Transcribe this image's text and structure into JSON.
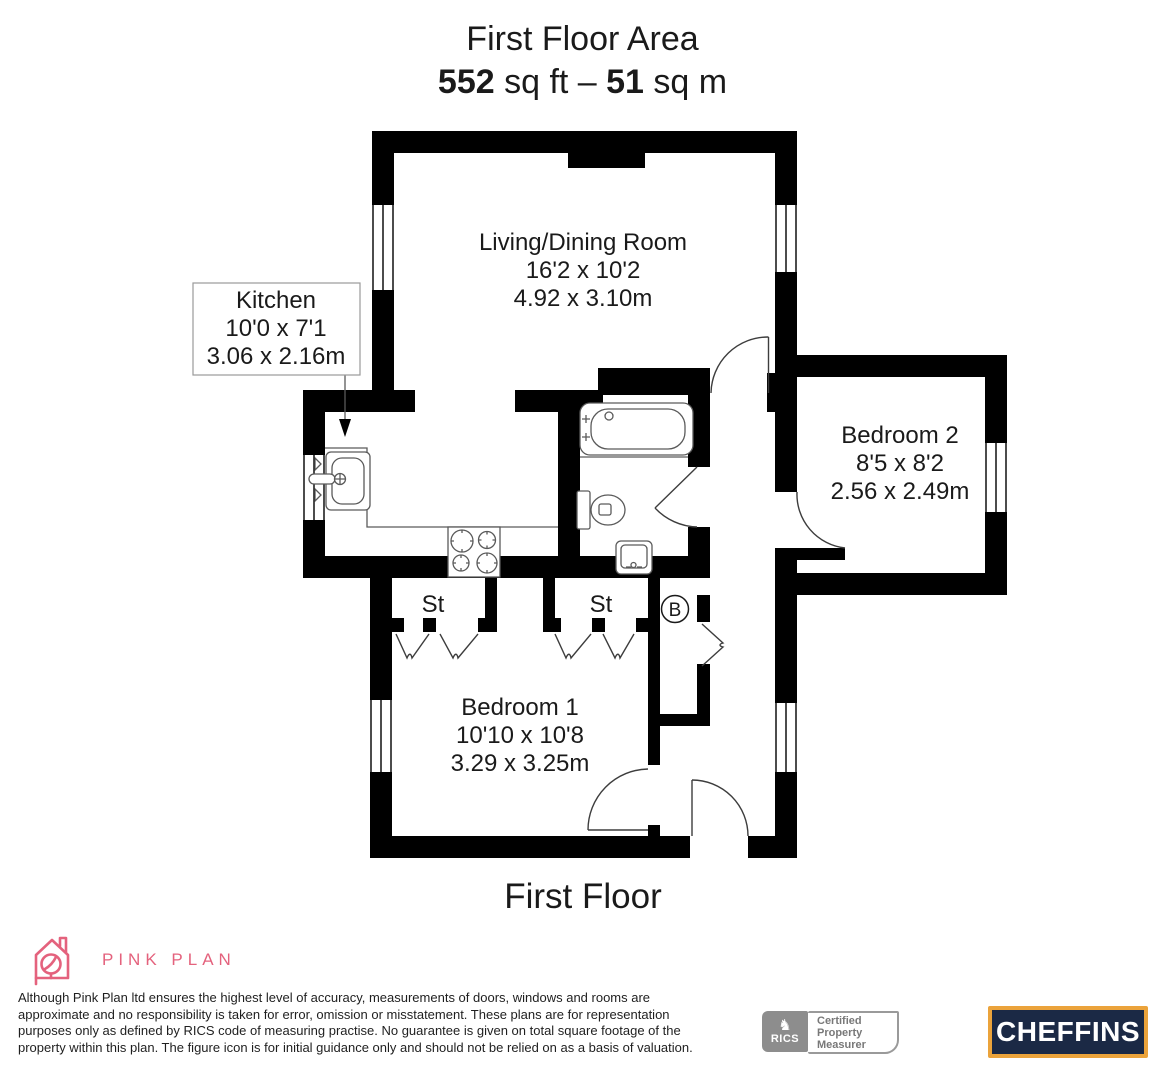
{
  "header": {
    "title": "First Floor Area",
    "area_sqft": "552",
    "area_sqft_unit": " sq ft – ",
    "area_sqm": "51",
    "area_sqm_unit": " sq m"
  },
  "floorplan": {
    "caption": "First Floor",
    "rooms": [
      {
        "name": "Living/Dining Room",
        "size_imperial": "16'2 x 10'2",
        "size_metric": "4.92 x 3.10m"
      },
      {
        "name": "Kitchen",
        "size_imperial": "10'0 x 7'1",
        "size_metric": "3.06 x 2.16m"
      },
      {
        "name": "Bedroom 2",
        "size_imperial": "8'5 x 8'2",
        "size_metric": "2.56 x 2.49m"
      },
      {
        "name": "Bedroom 1",
        "size_imperial": "10'10 x 10'8",
        "size_metric": "3.29 x 3.25m"
      }
    ],
    "storage_left": "St",
    "storage_right": "St",
    "boiler": "B"
  },
  "footer": {
    "brand": "PINK PLAN",
    "brand_color": "#e4627d",
    "disclaimer_lines": [
      "Although Pink Plan ltd ensures the highest level of accuracy, measurements of doors, windows and rooms are",
      "approximate and no responsibility is taken for error, omission or misstatement. These plans are for representation",
      "purposes only as defined by RICS code of measuring practise. No guarantee is given on total square footage of the",
      "property within this plan. The figure icon is for initial guidance only and should not be relied on as a basis of valuation."
    ],
    "rics_lion_icon": "♞",
    "rics_label": "RICS",
    "rics_cert_lines": [
      "Certified",
      "Property",
      "Measurer"
    ],
    "agent": "CHEFFINS",
    "agent_bg": "#1b2945",
    "agent_border": "#eba33b"
  }
}
